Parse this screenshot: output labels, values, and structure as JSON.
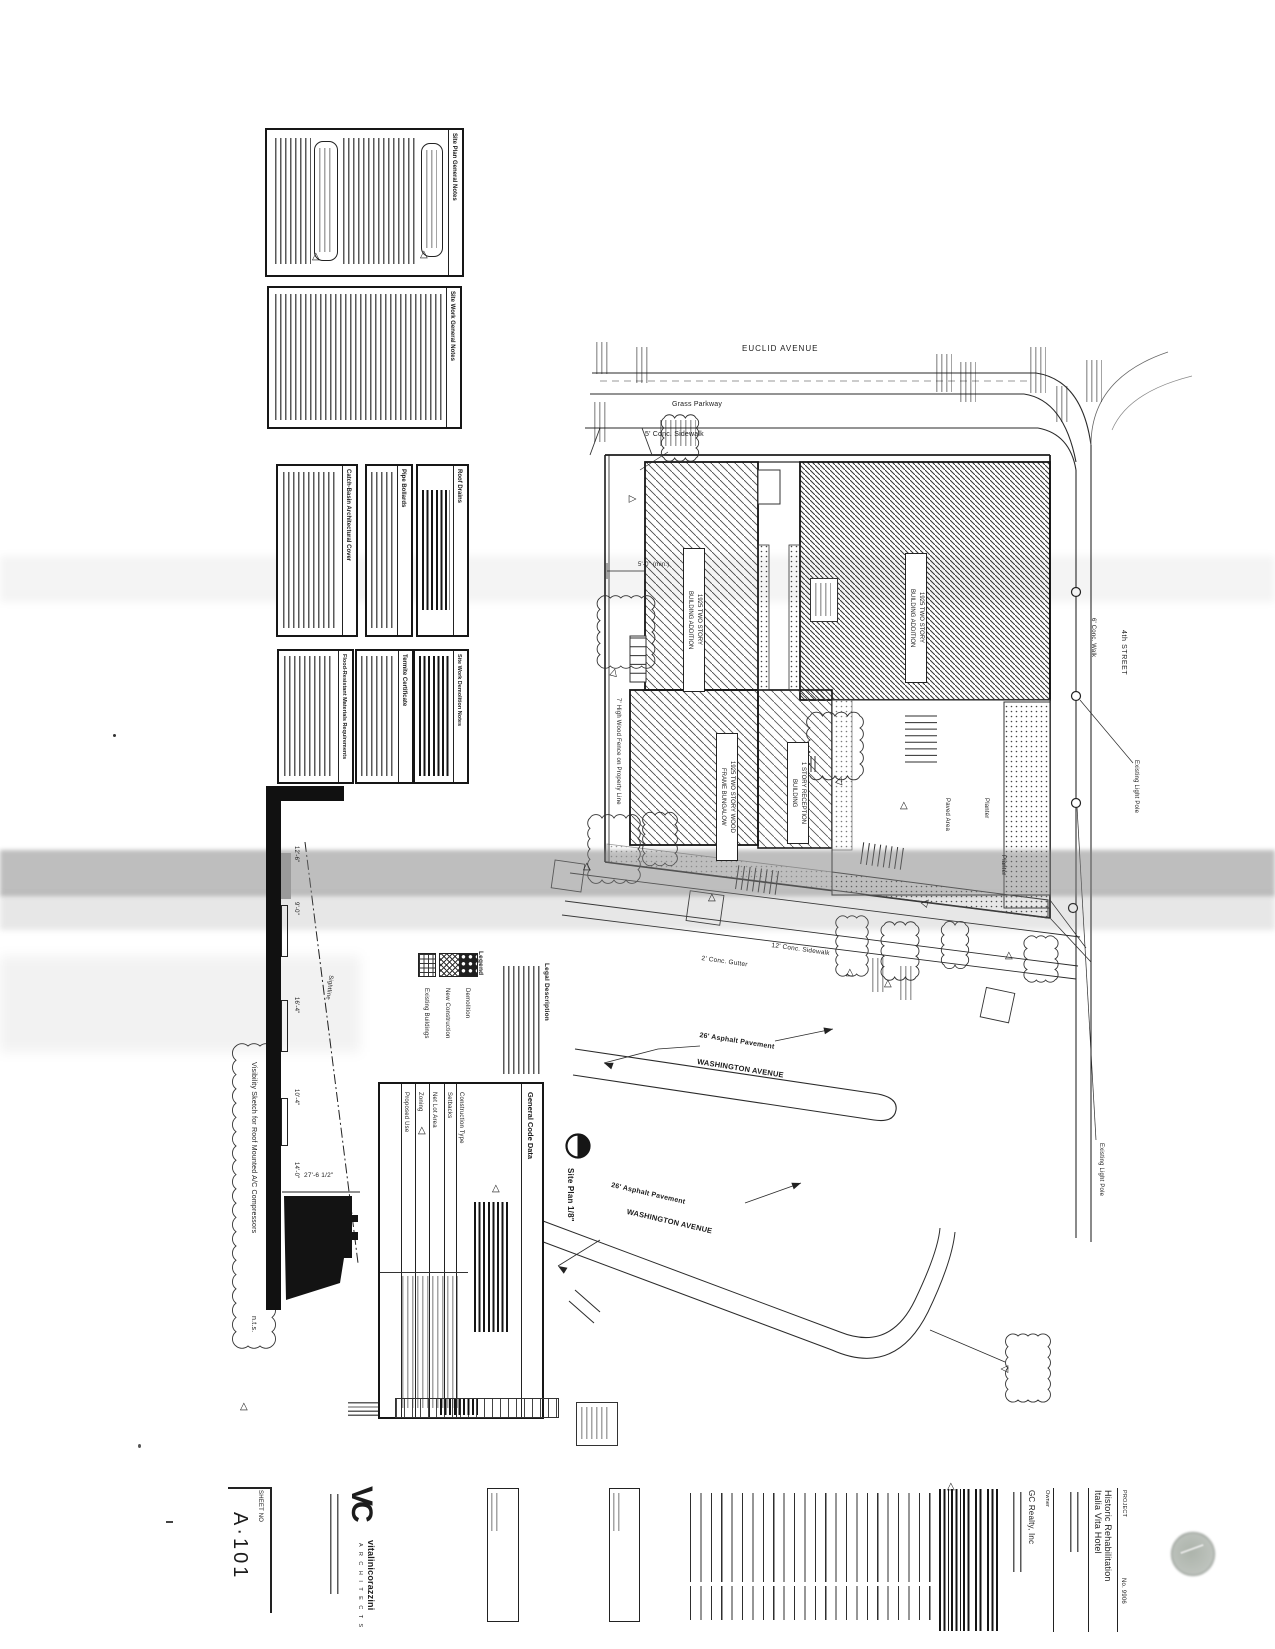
{
  "sheet": {
    "sheet_no_label": "SHEET NO",
    "sheet_no": "A·101",
    "drawing_caption": "Site Plan  1/8\""
  },
  "firm": {
    "logo": "VC",
    "name": "vitalinicorazzini",
    "type": "A R C H I T E C T S"
  },
  "project": {
    "label": "PROJECT",
    "title_line1": "Historic Rehabilitation",
    "title_line2": "Italia Vita Hotel",
    "owner_label": "Owner",
    "owner": "GC Realty, Inc",
    "number": "No. 9906"
  },
  "notes": {
    "box_a_title": "Site Plan General Notes",
    "box_b_title": "Site Work General Notes",
    "small_boxes": [
      "Catch-Basin Architectural Cover",
      "Pipe Bollards",
      "Roof Drains",
      "Flood-Resistant Materials Requirements",
      "Termite Certificate",
      "Site Work Demolition Notes"
    ]
  },
  "legend": {
    "title": "Legend",
    "items": [
      "Existing Buildings",
      "New Construction",
      "Demolition"
    ]
  },
  "legal": {
    "title": "Legal Description"
  },
  "code_table": {
    "title": "General Code Data",
    "rows": [
      "Proposed Use",
      "Zoning",
      "Net Lot Area",
      "Setbacks",
      "Construction Type"
    ]
  },
  "visibility": {
    "title": "Visibility Sketch for Roof Mounted A/C Compressors",
    "scale": "n.t.s.",
    "sightline_label": "Sightline",
    "dims": [
      "12'-6\"",
      "9'-0\"",
      "16'-4\"",
      "10'-4\"",
      "14'-0\""
    ],
    "width_dim": "27'-6 1/2\""
  },
  "plan": {
    "streets": {
      "euclid": "EUCLID AVENUE",
      "grass_parkway": "Grass Parkway",
      "sidewalk5": "5' Conc. Sidewalk",
      "sidewalk12": "12' Conc. Sidewalk",
      "gutter2": "2' Conc. Gutter",
      "asphalt": "26' Asphalt Pavement",
      "washington": "WASHINGTON AVENUE",
      "walk6": "6' Conc. Walk",
      "street4": "4th STREET",
      "light_pole": "Existing Light Pole"
    },
    "buildings": {
      "addition_l1": "1925 TWO STORY",
      "addition_l2": "BUILDING ADDITION",
      "bungalow_l1": "1925 TWO STORY WOOD",
      "bungalow_l2": "FRAME BUNGALOW",
      "reception_l1": "1 STORY RECEPTION",
      "reception_l2": "BUILDING",
      "paved_area": "Paved Area",
      "planter": "Planter",
      "fence": "7' High Wood Fence on Property Line",
      "fence_dim": "5'-0\" (min.)"
    }
  }
}
